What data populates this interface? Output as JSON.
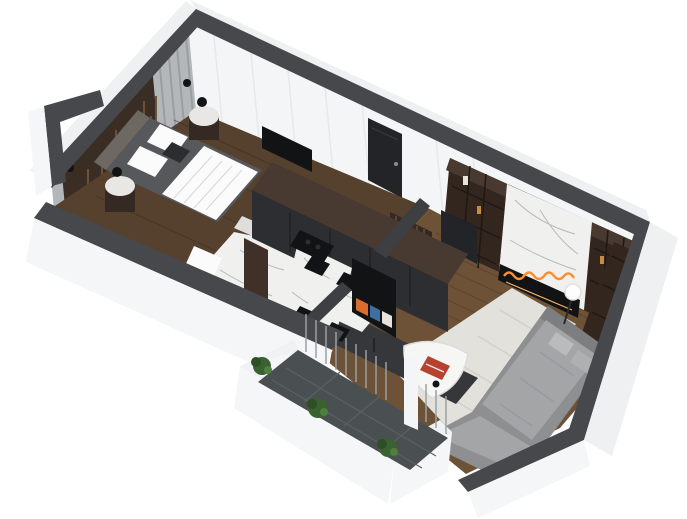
{
  "scene": {
    "type": "3d-isometric-floor-plan-render",
    "subject": "one-bedroom-apartment",
    "rooms": [
      {
        "name": "bedroom",
        "floor": "dark-wood-plank",
        "furniture": [
          "double-bed",
          "white-duvet",
          "pillows",
          "upholstered-headboard",
          "slat-feature-wall",
          "curtain-wall",
          "round-nightstand-left",
          "round-nightstand-right",
          "sphere-table-lamp-left",
          "sphere-table-lamp-right",
          "wall-sconce",
          "white-planter",
          "wall-tv-panel"
        ]
      },
      {
        "name": "bathroom",
        "floor": "marble",
        "furniture": [
          "bathtub",
          "glass-shower-screen",
          "marble-wall-panel"
        ]
      },
      {
        "name": "hallway",
        "floor": "wood-plank",
        "furniture": [
          "entry-door",
          "tall-cabinet-column"
        ]
      },
      {
        "name": "kitchen-dining",
        "floor": "wood-plank",
        "furniture": [
          "tall-dark-cabinet-unit",
          "marble-island",
          "black-cooktop",
          "marble-dining-table",
          "dining-chair-1",
          "dining-chair-2",
          "dining-chair-3",
          "dining-chair-4",
          "tv-screen",
          "wood-slat-partition",
          "dark-platform"
        ]
      },
      {
        "name": "living-room",
        "floor": "wood-plank",
        "furniture": [
          "sectional-sofa",
          "sofa-pillows",
          "area-rug",
          "triangular-coffee-table",
          "red-book",
          "media-wall-shelving",
          "marble-fireplace-panel",
          "linear-fireplace-flames",
          "globe-floor-lamp",
          "dark-door-panel"
        ]
      },
      {
        "name": "balcony",
        "floor": "slate-tile",
        "furniture": [
          "white-parapet",
          "shrub-1",
          "shrub-2",
          "shrub-3",
          "sheer-curtains",
          "white-post"
        ]
      }
    ],
    "palette": {
      "background": "#ffffff",
      "wallCap": "#46484c",
      "wallCapInterior": "#3d3f42",
      "wallOuter": "#eef0f1",
      "wallOuter2": "#f5f6f7",
      "wallInner": "#f4f5f6",
      "curtainWall": "#b3b7ba",
      "slatWall": "#3a2d24",
      "woodDark": "#55412e",
      "woodMid": "#6d5238",
      "marble": "#f0f0ee",
      "marbleVein": "#b6b9bb",
      "cabinetTop": "#493a31",
      "cabinetFront": "#2d2e32",
      "graphite": "#36373b",
      "tvBlack": "#121315",
      "door": "#232427",
      "sofa": "#8d8f91",
      "sofaCushion": "#a3a5a7",
      "rug": "#e3e1dc",
      "balconyTile": "#4a4f52",
      "plant": "#3a6130",
      "bedFrame": "#57585c",
      "headboard": "#6e6862",
      "mediaWood": "#33261f",
      "flame": "#ff8c2e",
      "flameGlow": "#ffb361",
      "accentRed": "#b6412e"
    }
  }
}
